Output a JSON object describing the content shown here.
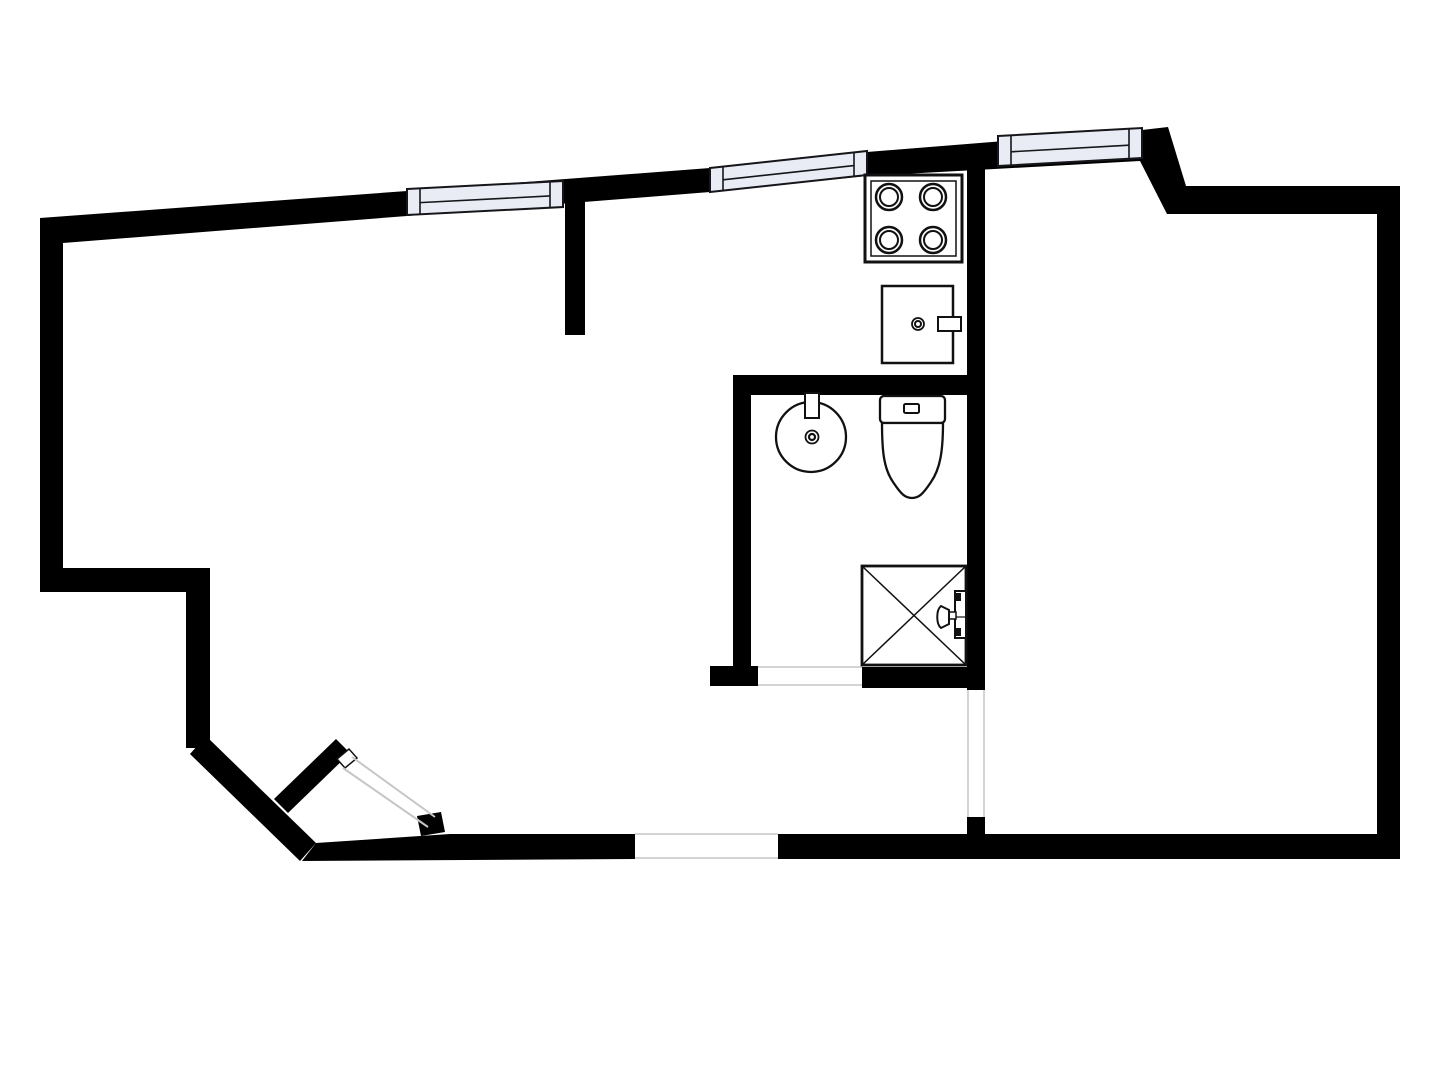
{
  "canvas": {
    "width": 1440,
    "height": 1080,
    "background": "#ffffff"
  },
  "palette": {
    "wall": "#000000",
    "fixture_stroke": "#111111",
    "fixture_fill": "#ffffff",
    "window_fill": "#e9ecf4",
    "window_stroke": "#15151a",
    "thin_line": "#c6c6c6"
  },
  "floor_plan": {
    "walls": [
      {
        "name": "top-exterior-wall",
        "type": "polygon",
        "points": "40,218 407,191 710,168 867,152 1142,130 1168,127 1186,186 1400,186 1400,214 1167,214 1140,161 867,176 710,192 407,216 63,243 40,245",
        "fill": "#000000"
      },
      {
        "name": "left-exterior-wall",
        "type": "polygon",
        "points": "40,218 63,218 63,592 40,592",
        "fill": "#000000"
      },
      {
        "name": "left-step-horizontal-wall",
        "type": "polygon",
        "points": "40,568 210,568 210,592 40,592",
        "fill": "#000000"
      },
      {
        "name": "left-step-vertical-wall",
        "type": "polygon",
        "points": "186,568 210,568 210,748 186,748",
        "fill": "#000000"
      },
      {
        "name": "entry-diagonal-wall",
        "type": "polygon",
        "points": "206,736 316,843 300,861 190,754",
        "fill": "#000000"
      },
      {
        "name": "bottom-wall-left",
        "type": "polygon",
        "points": "316,843 450,834 635,834 635,859 302,861",
        "fill": "#000000"
      },
      {
        "name": "bottom-wall-right",
        "type": "polygon",
        "points": "778,834 1400,834 1400,859 778,859",
        "fill": "#000000"
      },
      {
        "name": "right-exterior-wall",
        "type": "polygon",
        "points": "1377,186 1400,186 1400,859 1377,859",
        "fill": "#000000"
      },
      {
        "name": "kitchen-divider-wall",
        "type": "polygon",
        "points": "565,186 585,186 585,335 565,335",
        "fill": "#000000"
      },
      {
        "name": "hall-partition-wall-upper",
        "type": "polygon",
        "points": "967,150 985,150 985,690 967,690",
        "fill": "#000000"
      },
      {
        "name": "hall-partition-wall-stub",
        "type": "polygon",
        "points": "967,817 985,817 985,859 967,859",
        "fill": "#000000"
      },
      {
        "name": "bathroom-top-wall",
        "type": "polygon",
        "points": "733,375 985,375 985,395 733,395",
        "fill": "#000000"
      },
      {
        "name": "bathroom-left-wall",
        "type": "polygon",
        "points": "733,375 751,375 751,670 733,670",
        "fill": "#000000"
      },
      {
        "name": "bathroom-door-jamb-stub",
        "type": "polygon",
        "points": "710,666 758,666 758,686 710,686",
        "fill": "#000000"
      },
      {
        "name": "bathroom-bottom-wall",
        "type": "polygon",
        "points": "862,667 985,667 985,688 862,688",
        "fill": "#000000"
      },
      {
        "name": "entrance-door-jamb-stub",
        "type": "polygon",
        "points": "417,816 441,812 445,832 421,836",
        "fill": "#000000"
      }
    ],
    "openings": [
      {
        "name": "bathroom-door-opening",
        "type": "rect",
        "x": 758,
        "y": 664,
        "w": 104,
        "h": 24,
        "fill": "#ffffff"
      },
      {
        "name": "bathroom-door-threshold-top",
        "type": "line",
        "x1": 758,
        "y1": 667,
        "x2": 862,
        "y2": 667,
        "stroke": "#c6c6c6",
        "sw": 1.5
      },
      {
        "name": "bathroom-door-threshold-bottom",
        "type": "line",
        "x1": 758,
        "y1": 685,
        "x2": 862,
        "y2": 685,
        "stroke": "#c6c6c6",
        "sw": 1.5
      },
      {
        "name": "hall-door-opening",
        "type": "rect",
        "x": 966,
        "y": 690,
        "w": 20,
        "h": 127,
        "fill": "#ffffff"
      },
      {
        "name": "hall-door-edge-left",
        "type": "line",
        "x1": 968,
        "y1": 690,
        "x2": 968,
        "y2": 817,
        "stroke": "#c6c6c6",
        "sw": 1.5
      },
      {
        "name": "hall-door-edge-right",
        "type": "line",
        "x1": 984,
        "y1": 690,
        "x2": 984,
        "y2": 817,
        "stroke": "#c6c6c6",
        "sw": 1.5
      },
      {
        "name": "terrace-opening",
        "type": "rect",
        "x": 635,
        "y": 832,
        "w": 143,
        "h": 29,
        "fill": "#ffffff"
      },
      {
        "name": "terrace-opening-edge-top",
        "type": "line",
        "x1": 635,
        "y1": 834,
        "x2": 778,
        "y2": 834,
        "stroke": "#c6c6c6",
        "sw": 1.5
      },
      {
        "name": "terrace-opening-edge-bottom",
        "type": "line",
        "x1": 635,
        "y1": 858,
        "x2": 778,
        "y2": 858,
        "stroke": "#c6c6c6",
        "sw": 1.5
      }
    ],
    "windows": [
      {
        "name": "window-1",
        "type": "window",
        "x1": 407,
        "t1": 189,
        "x2": 563,
        "t2": 181,
        "th": 26,
        "cap": 13,
        "line_f": 0.55,
        "fill": "#e9ecf4",
        "stroke": "#15151a"
      },
      {
        "name": "window-2",
        "type": "window",
        "x1": 710,
        "t1": 168,
        "x2": 867,
        "t2": 151,
        "th": 24,
        "cap": 13,
        "line_f": 0.55,
        "fill": "#e9ecf4",
        "stroke": "#15151a"
      },
      {
        "name": "window-3",
        "type": "window",
        "x1": 998,
        "t1": 136,
        "x2": 1142,
        "t2": 128,
        "th": 30,
        "cap": 13,
        "line_f": 0.55,
        "fill": "#e9ecf4",
        "stroke": "#15151a"
      }
    ],
    "entrance_door": [
      {
        "name": "entrance-door-leaf",
        "type": "polygon",
        "points": "288,813 274,799 336,739 350,753",
        "fill": "#000000"
      },
      {
        "name": "entrance-door-leaf-cap",
        "type": "polygon",
        "points": "337,759 349,749 357,758 345,768",
        "fill": "#ffffff",
        "stroke": "#111111",
        "sw": 1.5
      },
      {
        "name": "entrance-door-swing-line-1",
        "type": "line",
        "x1": 352,
        "y1": 757,
        "x2": 435,
        "y2": 817,
        "stroke": "#c6c6c6",
        "sw": 2
      },
      {
        "name": "entrance-door-swing-line-2",
        "type": "line",
        "x1": 343,
        "y1": 768,
        "x2": 428,
        "y2": 827,
        "stroke": "#c6c6c6",
        "sw": 2
      }
    ],
    "fixtures": [
      {
        "name": "stove-outline",
        "type": "rect",
        "x": 865,
        "y": 175,
        "w": 97,
        "h": 87,
        "fill": "#ffffff",
        "stroke": "#111111",
        "sw": 3
      },
      {
        "name": "stove-inner-outline",
        "type": "rect",
        "x": 871,
        "y": 181,
        "w": 85,
        "h": 75,
        "fill": "none",
        "stroke": "#111111",
        "sw": 1.5
      },
      {
        "name": "stove-burner-top-left",
        "type": "circle",
        "cx": 889,
        "cy": 197,
        "r": 13,
        "fill": "#ffffff",
        "stroke": "#111111",
        "sw": 2.5
      },
      {
        "name": "stove-burner-top-left-inner",
        "type": "circle",
        "cx": 889,
        "cy": 197,
        "r": 9,
        "fill": "none",
        "stroke": "#111111",
        "sw": 2
      },
      {
        "name": "stove-burner-top-right",
        "type": "circle",
        "cx": 933,
        "cy": 197,
        "r": 13,
        "fill": "#ffffff",
        "stroke": "#111111",
        "sw": 2.5
      },
      {
        "name": "stove-burner-top-right-inner",
        "type": "circle",
        "cx": 933,
        "cy": 197,
        "r": 9,
        "fill": "none",
        "stroke": "#111111",
        "sw": 2
      },
      {
        "name": "stove-burner-bottom-left",
        "type": "circle",
        "cx": 889,
        "cy": 240,
        "r": 13,
        "fill": "#ffffff",
        "stroke": "#111111",
        "sw": 2.5
      },
      {
        "name": "stove-burner-bottom-left-inner",
        "type": "circle",
        "cx": 889,
        "cy": 240,
        "r": 9,
        "fill": "none",
        "stroke": "#111111",
        "sw": 2
      },
      {
        "name": "stove-burner-bottom-right",
        "type": "circle",
        "cx": 933,
        "cy": 240,
        "r": 13,
        "fill": "#ffffff",
        "stroke": "#111111",
        "sw": 2.5
      },
      {
        "name": "stove-burner-bottom-right-inner",
        "type": "circle",
        "cx": 933,
        "cy": 240,
        "r": 9,
        "fill": "none",
        "stroke": "#111111",
        "sw": 2
      },
      {
        "name": "kitchen-sink-outline",
        "type": "rect",
        "x": 882,
        "y": 286,
        "w": 71,
        "h": 77,
        "fill": "#ffffff",
        "stroke": "#111111",
        "sw": 2.5
      },
      {
        "name": "kitchen-sink-faucet-tab",
        "type": "rect",
        "x": 938,
        "y": 317,
        "w": 23,
        "h": 14,
        "fill": "#ffffff",
        "stroke": "#111111",
        "sw": 2
      },
      {
        "name": "kitchen-sink-drain-outer",
        "type": "circle",
        "cx": 918,
        "cy": 324,
        "r": 6,
        "fill": "#ffffff",
        "stroke": "#111111",
        "sw": 1.8
      },
      {
        "name": "kitchen-sink-drain-inner",
        "type": "circle",
        "cx": 918,
        "cy": 324,
        "r": 3,
        "fill": "none",
        "stroke": "#111111",
        "sw": 2
      },
      {
        "name": "washbasin-bowl",
        "type": "circle",
        "cx": 811,
        "cy": 437,
        "r": 35,
        "fill": "#ffffff",
        "stroke": "#111111",
        "sw": 2.3
      },
      {
        "name": "washbasin-tap",
        "type": "rect",
        "x": 805,
        "y": 393,
        "w": 14,
        "h": 25,
        "fill": "#ffffff",
        "stroke": "#111111",
        "sw": 2
      },
      {
        "name": "washbasin-drain-outer",
        "type": "circle",
        "cx": 812,
        "cy": 437,
        "r": 6.5,
        "fill": "#ffffff",
        "stroke": "#111111",
        "sw": 1.8
      },
      {
        "name": "washbasin-drain-inner",
        "type": "circle",
        "cx": 812,
        "cy": 437,
        "r": 3,
        "fill": "none",
        "stroke": "#111111",
        "sw": 2.2
      },
      {
        "name": "toilet-tank",
        "type": "rect",
        "x": 880,
        "y": 396,
        "w": 65,
        "h": 27,
        "rx": 4,
        "fill": "#ffffff",
        "stroke": "#111111",
        "sw": 2.3
      },
      {
        "name": "toilet-flush-button",
        "type": "rect",
        "x": 904,
        "y": 404,
        "w": 15,
        "h": 9,
        "rx": 1.5,
        "fill": "#ffffff",
        "stroke": "#111111",
        "sw": 2
      },
      {
        "name": "toilet-bowl",
        "type": "path",
        "d": "M882,423 L943,423 C943,452 940,469 931,482 C923,494 919,498 912,498 C905,498 901,494 893,482 C884,469 882,452 882,423 Z",
        "fill": "#ffffff",
        "stroke": "#111111",
        "sw": 2.3
      },
      {
        "name": "shower-tray",
        "type": "rect",
        "x": 862,
        "y": 566,
        "w": 104,
        "h": 99,
        "fill": "#ffffff",
        "stroke": "#111111",
        "sw": 2.8
      },
      {
        "name": "shower-diagonal-1",
        "type": "line",
        "x1": 862,
        "y1": 566,
        "x2": 966,
        "y2": 665,
        "stroke": "#111111",
        "sw": 1.5
      },
      {
        "name": "shower-diagonal-2",
        "type": "line",
        "x1": 966,
        "y1": 566,
        "x2": 862,
        "y2": 665,
        "stroke": "#111111",
        "sw": 1.5
      },
      {
        "name": "shower-mixer-bar",
        "type": "rect",
        "x": 955,
        "y": 591,
        "w": 11,
        "h": 47,
        "fill": "#ffffff",
        "stroke": "#111111",
        "sw": 2
      },
      {
        "name": "shower-mixer-top-block",
        "type": "rect",
        "x": 955,
        "y": 593,
        "w": 6,
        "h": 8,
        "fill": "#111111"
      },
      {
        "name": "shower-mixer-bottom-block",
        "type": "rect",
        "x": 955,
        "y": 628,
        "w": 6,
        "h": 8,
        "fill": "#111111"
      },
      {
        "name": "shower-mixer-center-line",
        "type": "line",
        "x1": 955,
        "y1": 617,
        "x2": 966,
        "y2": 617,
        "stroke": "#111111",
        "sw": 1.2
      },
      {
        "name": "shower-handle-stem",
        "type": "rect",
        "x": 948,
        "y": 612,
        "w": 8,
        "h": 7,
        "fill": "#ffffff",
        "stroke": "#111111",
        "sw": 1.5
      },
      {
        "name": "shower-handle",
        "type": "path",
        "d": "M949,610 L941,606 C936,610 936,624 941,628 L949,624 Z",
        "fill": "#ffffff",
        "stroke": "#111111",
        "sw": 2
      }
    ]
  }
}
